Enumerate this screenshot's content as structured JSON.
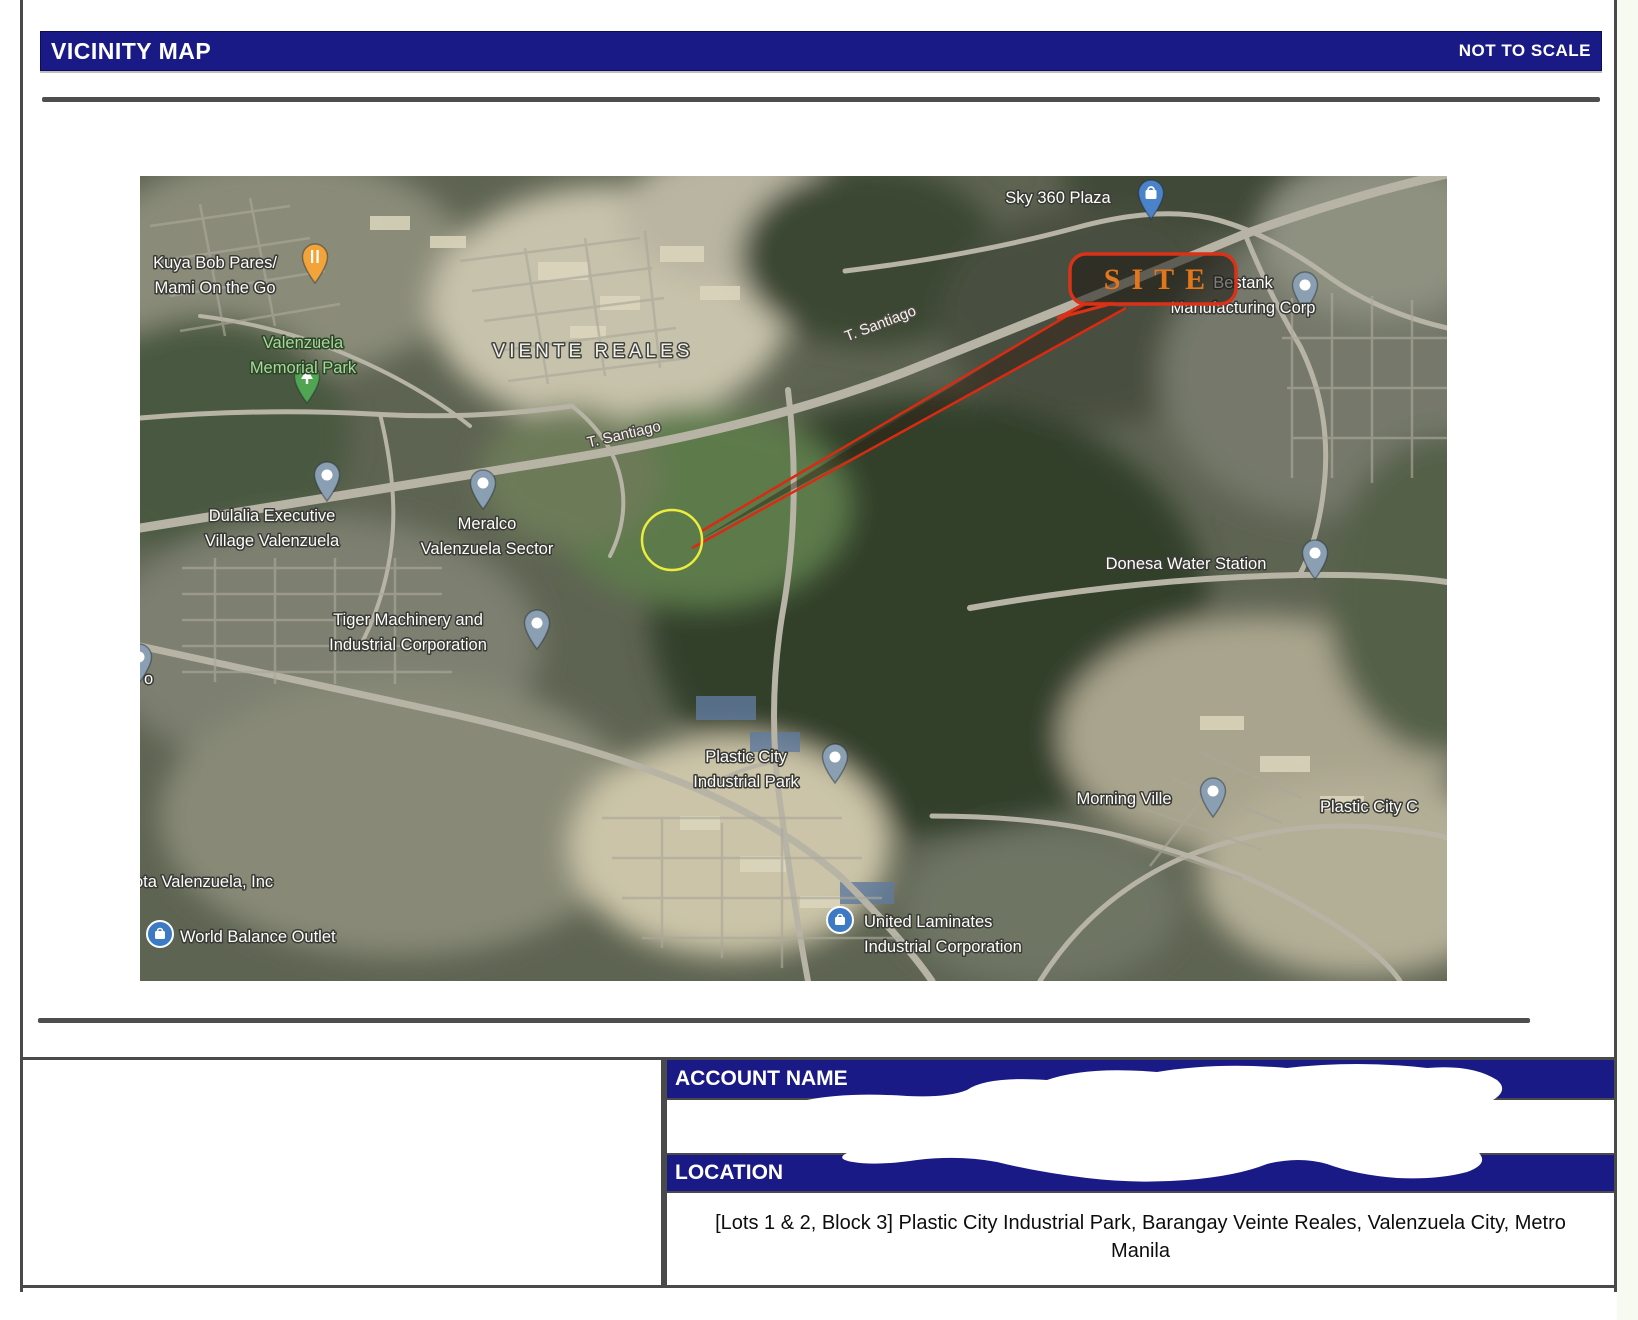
{
  "header": {
    "title": "VICINITY MAP",
    "scale_note": "NOT TO SCALE"
  },
  "map": {
    "site_label": "SITE",
    "labels": [
      {
        "id": "kuya-bob-pares",
        "lines": [
          "Kuya Bob Pares/",
          "Mami On the Go"
        ],
        "x": 75,
        "y": 92,
        "kind": "place"
      },
      {
        "id": "valenzuela-memorial-park",
        "lines": [
          "Valenzuela",
          "Memorial Park"
        ],
        "x": 163,
        "y": 172,
        "kind": "park"
      },
      {
        "id": "viente-reales",
        "lines": [
          "VIENTE REALES"
        ],
        "x": 453,
        "y": 181,
        "kind": "district"
      },
      {
        "id": "t-santiago-upper",
        "lines": [
          "T. Santiago"
        ],
        "x": 742,
        "y": 152,
        "kind": "road",
        "rotate": -21
      },
      {
        "id": "t-santiago-lower",
        "lines": [
          "T. Santiago"
        ],
        "x": 485,
        "y": 263,
        "kind": "road",
        "rotate": -13
      },
      {
        "id": "sky-360-plaza",
        "lines": [
          "Sky 360 Plaza"
        ],
        "x": 918,
        "y": 27,
        "kind": "place"
      },
      {
        "id": "bestank-manufacturing",
        "lines": [
          "Bestank",
          "Manufacturing Corp"
        ],
        "x": 1103,
        "y": 112,
        "kind": "place"
      },
      {
        "id": "dulalia-executive-village",
        "lines": [
          "Dulalia Executive",
          "Village Valenzuela"
        ],
        "x": 132,
        "y": 345,
        "kind": "place"
      },
      {
        "id": "meralco-valenzuela-sector",
        "lines": [
          "Meralco",
          "Valenzuela Sector"
        ],
        "x": 347,
        "y": 353,
        "kind": "place"
      },
      {
        "id": "donesa-water-station",
        "lines": [
          "Donesa Water Station"
        ],
        "x": 1046,
        "y": 393,
        "kind": "place"
      },
      {
        "id": "tiger-machinery",
        "lines": [
          "Tiger Machinery and",
          "Industrial Corporation"
        ],
        "x": 268,
        "y": 449,
        "kind": "place"
      },
      {
        "id": "plastic-city-industrial-park",
        "lines": [
          "Plastic City",
          "Industrial Park"
        ],
        "x": 606,
        "y": 586,
        "kind": "place"
      },
      {
        "id": "morning-ville",
        "lines": [
          "Morning Ville"
        ],
        "x": 984,
        "y": 628,
        "kind": "place"
      },
      {
        "id": "plastic-city-c",
        "lines": [
          "Plastic City C"
        ],
        "x": 1180,
        "y": 636,
        "kind": "place",
        "anchor": "start"
      },
      {
        "id": "toyota-valenzuela",
        "lines": [
          "ota Valenzuela, Inc"
        ],
        "x": -6,
        "y": 711,
        "kind": "place",
        "anchor": "start"
      },
      {
        "id": "label-remnant-o",
        "lines": [
          "o"
        ],
        "x": 4,
        "y": 508,
        "kind": "place",
        "anchor": "start"
      },
      {
        "id": "world-balance-outlet",
        "lines": [
          "World Balance Outlet"
        ],
        "x": 40,
        "y": 766,
        "kind": "place",
        "anchor": "start"
      },
      {
        "id": "united-laminates",
        "lines": [
          "United Laminates",
          "Industrial Corporation"
        ],
        "x": 724,
        "y": 751,
        "kind": "place",
        "anchor": "start"
      }
    ],
    "pins": [
      {
        "type": "food",
        "x": 160,
        "y": 66
      },
      {
        "type": "park",
        "x": 152,
        "y": 186
      },
      {
        "type": "shop",
        "x": 996,
        "y": 2
      },
      {
        "type": "place",
        "x": 1150,
        "y": 94
      },
      {
        "type": "place",
        "x": 172,
        "y": 284
      },
      {
        "type": "place",
        "x": 328,
        "y": 292
      },
      {
        "type": "place",
        "x": 1160,
        "y": 362
      },
      {
        "type": "place",
        "x": 382,
        "y": 432
      },
      {
        "type": "place",
        "x": 680,
        "y": 566
      },
      {
        "type": "place",
        "x": 1058,
        "y": 600
      },
      {
        "type": "place",
        "x": -16,
        "y": 466
      },
      {
        "type": "circle-shop",
        "x": 6,
        "y": 744
      },
      {
        "type": "circle-shop",
        "x": 686,
        "y": 730
      }
    ]
  },
  "panel": {
    "account_label": "ACCOUNT NAME",
    "location_label": "LOCATION",
    "location_value": "[Lots 1 & 2, Block 3] Plastic City Industrial Park, Barangay Veinte Reales, Valenzuela City, Metro Manila"
  },
  "colors": {
    "bar_navy": "#1a1a87",
    "site_outline": "#d93218",
    "site_text": "#e2761d",
    "leader_red": "#d92b12",
    "circle_yellow": "#ecec3d"
  }
}
